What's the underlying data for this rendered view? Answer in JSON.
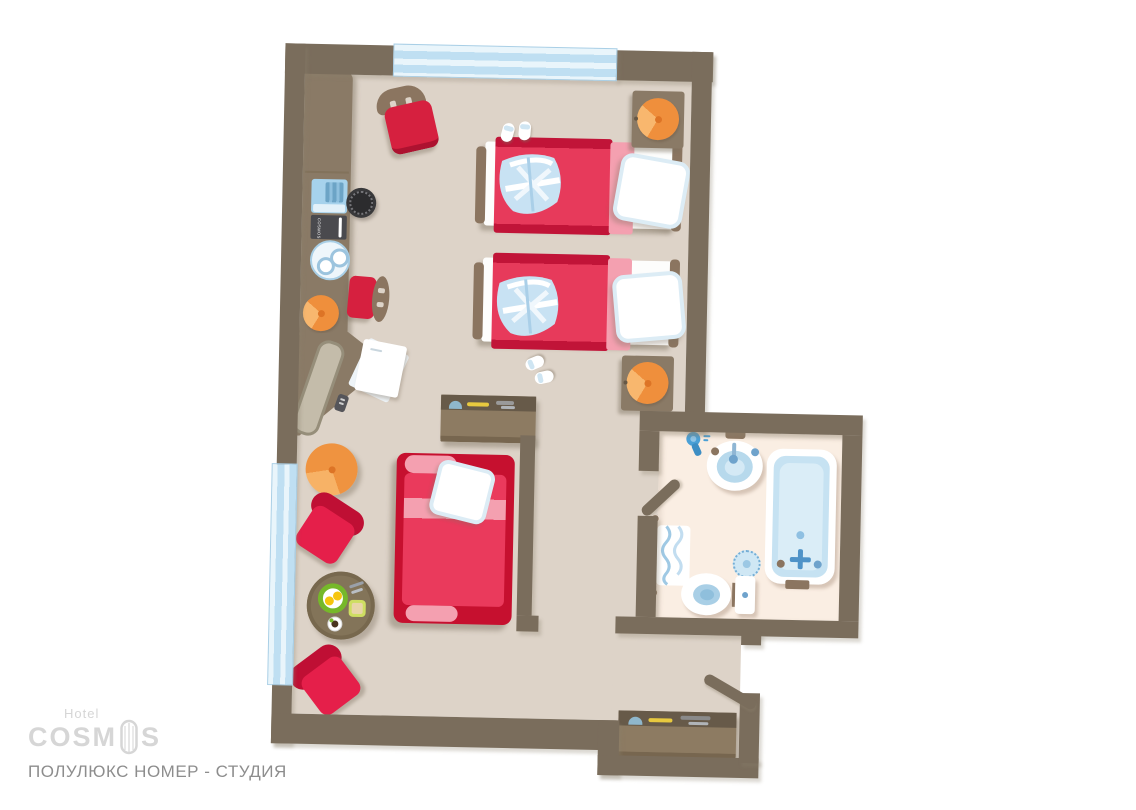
{
  "title": {
    "text": "ПОЛУЛЮКС НОМЕР - СТУДИЯ"
  },
  "branding": {
    "hotel_label": "Hotel",
    "logo_prefix": "COSM",
    "logo_suffix": "S",
    "logo_full": "COSMOS"
  },
  "wardrobe": {
    "menu_label": "COSMOS"
  },
  "colors": {
    "wall": "#7a6d5c",
    "floor": "#ddd3c8",
    "bathroom_floor": "#faeee3",
    "window_blue": "#bfdff2",
    "bed_cover": "#e73a5b",
    "bed_cover_dark": "#c11438",
    "blanket_fold": "#f4a0b0",
    "armchair_red": "#e51f4a",
    "wood_furniture": "#8a7a66",
    "lamp_orange": "#ef8f3c",
    "fixture_blue": "#bcdcee",
    "logo_gray": "#d6d6d6",
    "title_gray": "#8d8d8d"
  },
  "plan_items": [
    "twin-bed-1",
    "twin-bed-2",
    "sofa-bed",
    "wardrobe-console",
    "tv",
    "menu-folder",
    "service-tray",
    "speaker",
    "table-lamp",
    "desk",
    "mirror-panel",
    "remote",
    "notepad",
    "dining-chair",
    "desk-chair",
    "ottoman-pouf",
    "armchair-1",
    "armchair-2",
    "breakfast-table",
    "eggs-plate",
    "butter-dish",
    "coffee-cup",
    "cutlery",
    "dresser",
    "nightstand-1",
    "nightstand-2",
    "bathrobe",
    "slippers",
    "sink",
    "hairdryer",
    "bathtub",
    "floor-drain",
    "toilet",
    "towel-rack",
    "bathroom-door",
    "entry-door",
    "entry-console",
    "window-top",
    "window-left"
  ]
}
